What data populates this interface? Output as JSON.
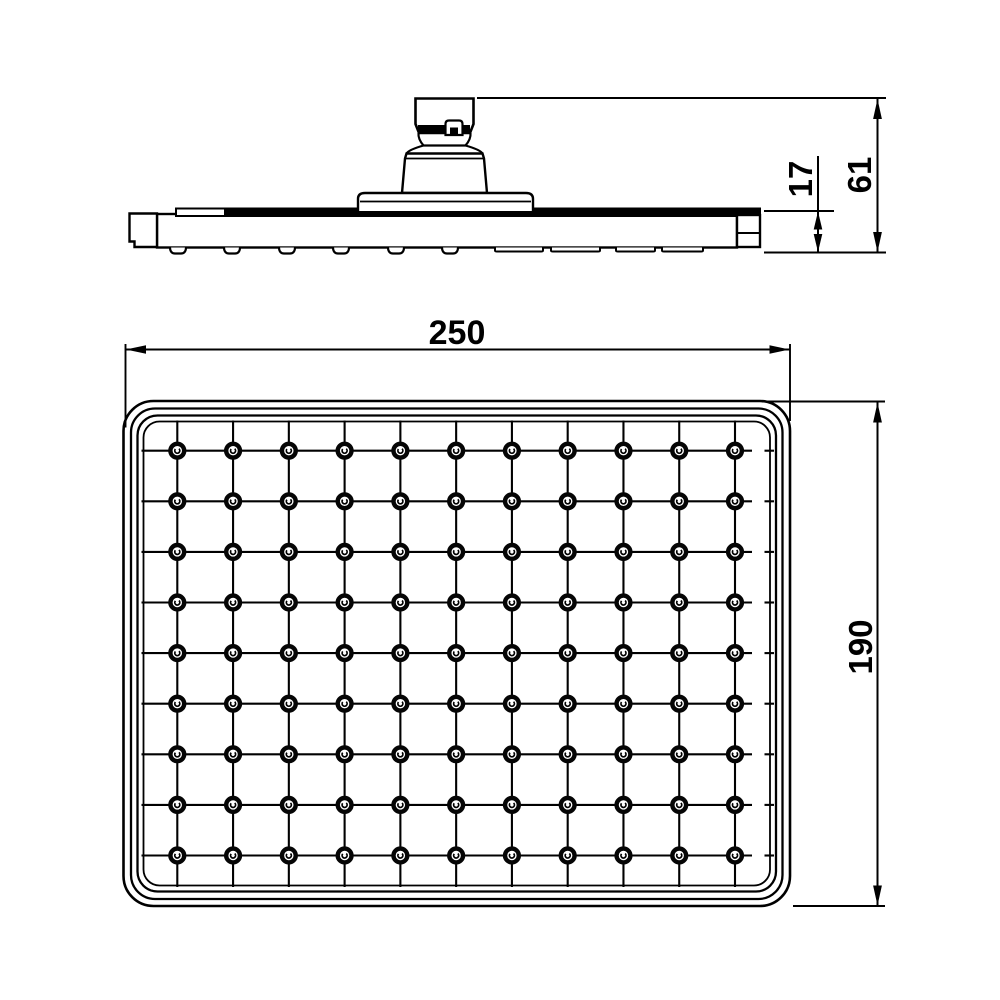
{
  "page": {
    "background_color": "#ffffff",
    "line_color": "#000000"
  },
  "drawing": {
    "type": "technical_drawing_two_views",
    "subject": "rectangular rain shower head",
    "side_view": {
      "description": "side elevation with mounting connector",
      "dim_head_thickness": "17",
      "dim_overall_height": "61"
    },
    "face_view": {
      "description": "spray face with nozzle grid",
      "dim_width": "250",
      "dim_height": "190",
      "nozzle_columns": 11,
      "nozzle_rows": 9,
      "nozzle_total": 99
    }
  }
}
